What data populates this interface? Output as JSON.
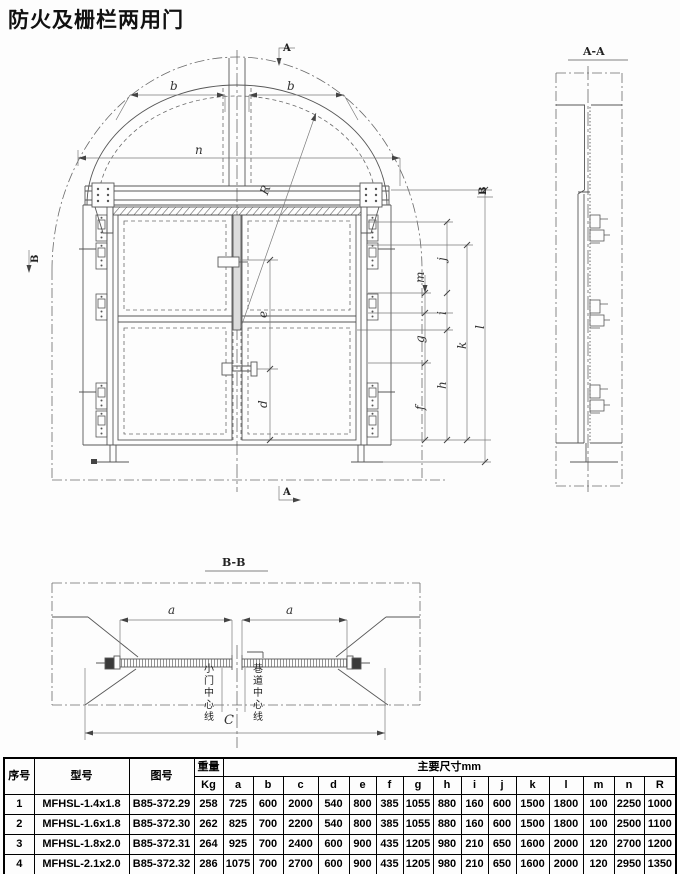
{
  "title": "防火及栅栏两用门",
  "drawing": {
    "front_view": {
      "dim_labels": {
        "b_left": "b",
        "b_right": "b",
        "n": "n",
        "radius": "R",
        "e": "e",
        "d": "d",
        "f": "f",
        "g": "g",
        "h": "h",
        "i": "i",
        "j": "j",
        "k": "k",
        "l": "l",
        "m": "m"
      },
      "section_markers": {
        "top": "A",
        "bottom": "A",
        "left": "B",
        "right": "B"
      }
    },
    "side_view": {
      "title": "A-A"
    },
    "plan_section": {
      "title": "B-B",
      "a_left": "a",
      "a_right": "a",
      "c": "C",
      "small_door_centerline": "小门中心线",
      "roadway_centerline": "巷道中心线"
    }
  },
  "table": {
    "headers": {
      "xuhao": "序号",
      "xinghao": "型号",
      "tuhao": "图号",
      "zhongliang": "重量",
      "kg": "Kg",
      "main_dims": "主要尺寸mm",
      "dim_letters": [
        "a",
        "b",
        "c",
        "d",
        "e",
        "f",
        "g",
        "h",
        "i",
        "j",
        "k",
        "l",
        "m",
        "n",
        "R"
      ]
    },
    "rows": [
      {
        "no": "1",
        "model": "MFHSL-1.4x1.8",
        "drawing_no": "B85-372.29",
        "weight": "258",
        "dims": [
          "725",
          "600",
          "2000",
          "540",
          "800",
          "385",
          "1055",
          "880",
          "160",
          "600",
          "1500",
          "1800",
          "100",
          "2250",
          "1000"
        ]
      },
      {
        "no": "2",
        "model": "MFHSL-1.6x1.8",
        "drawing_no": "B85-372.30",
        "weight": "262",
        "dims": [
          "825",
          "700",
          "2200",
          "540",
          "800",
          "385",
          "1055",
          "880",
          "160",
          "600",
          "1500",
          "1800",
          "100",
          "2500",
          "1100"
        ]
      },
      {
        "no": "3",
        "model": "MFHSL-1.8x2.0",
        "drawing_no": "B85-372.31",
        "weight": "264",
        "dims": [
          "925",
          "700",
          "2400",
          "600",
          "900",
          "435",
          "1205",
          "980",
          "210",
          "650",
          "1600",
          "2000",
          "120",
          "2700",
          "1200"
        ]
      },
      {
        "no": "4",
        "model": "MFHSL-2.1x2.0",
        "drawing_no": "B85-372.32",
        "weight": "286",
        "dims": [
          "1075",
          "700",
          "2700",
          "600",
          "900",
          "435",
          "1205",
          "980",
          "210",
          "650",
          "1600",
          "2000",
          "120",
          "2950",
          "1350"
        ]
      }
    ]
  }
}
